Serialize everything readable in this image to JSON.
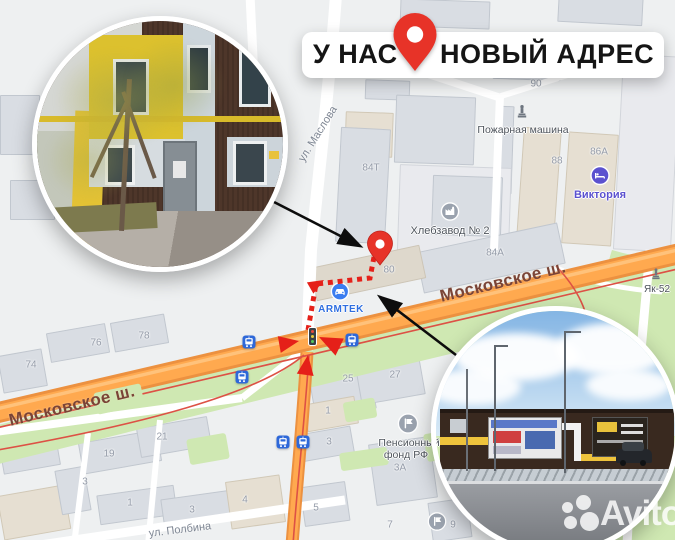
{
  "banner": {
    "left": "У НАС",
    "right": "НОВЫЙ АДРЕС"
  },
  "map": {
    "road_labels": {
      "moscow_1": "Московское ш.",
      "moscow_2": "Московское ш."
    },
    "street_labels": {
      "maslova": "ул. Маслова",
      "polbina": "ул. Полбина",
      "zapadny": "Западный бульв"
    },
    "pois": {
      "pozharnaya": "Пожарная машина",
      "khlebzavod": "Хлебзавод № 2",
      "viktoria": "Виктория",
      "pension_line1": "Пенсионный",
      "pension_line2": "фонд РФ",
      "yak52": "Як-52",
      "armtek": "ARMTEK"
    },
    "house_numbers": [
      {
        "t": "90",
        "x": 536,
        "y": 84
      },
      {
        "t": "84Т",
        "x": 371,
        "y": 168
      },
      {
        "t": "88",
        "x": 557,
        "y": 161
      },
      {
        "t": "86А",
        "x": 599,
        "y": 152
      },
      {
        "t": "84А",
        "x": 495,
        "y": 253
      },
      {
        "t": "80",
        "x": 389,
        "y": 270
      },
      {
        "t": "74",
        "x": 31,
        "y": 365
      },
      {
        "t": "76",
        "x": 96,
        "y": 343
      },
      {
        "t": "78",
        "x": 144,
        "y": 336
      },
      {
        "t": "25",
        "x": 348,
        "y": 379
      },
      {
        "t": "27",
        "x": 395,
        "y": 375
      },
      {
        "t": "21",
        "x": 162,
        "y": 437
      },
      {
        "t": "19",
        "x": 109,
        "y": 454
      },
      {
        "t": "3",
        "x": 85,
        "y": 482
      },
      {
        "t": "1",
        "x": 130,
        "y": 503
      },
      {
        "t": "3",
        "x": 192,
        "y": 510
      },
      {
        "t": "4",
        "x": 245,
        "y": 500
      },
      {
        "t": "5",
        "x": 316,
        "y": 508
      },
      {
        "t": "1",
        "x": 328,
        "y": 411
      },
      {
        "t": "3",
        "x": 329,
        "y": 442
      },
      {
        "t": "3А",
        "x": 400,
        "y": 468
      },
      {
        "t": "7",
        "x": 390,
        "y": 525
      },
      {
        "t": "9",
        "x": 453,
        "y": 525
      }
    ],
    "tram_stops": [
      {
        "x": 249,
        "y": 342
      },
      {
        "x": 242,
        "y": 377
      },
      {
        "x": 352,
        "y": 340
      },
      {
        "x": 283,
        "y": 442
      },
      {
        "x": 303,
        "y": 442
      }
    ]
  },
  "watermark": {
    "text": "Avito"
  },
  "colors": {
    "pin_red": "#e73328",
    "route_red": "#e52019",
    "road_orange": "#ffa94f",
    "tram_blue": "#2e68d9",
    "viktoria_purple": "#5b51cf",
    "armtek_blue": "#2f6fe0",
    "green": "#cfe8b2"
  }
}
